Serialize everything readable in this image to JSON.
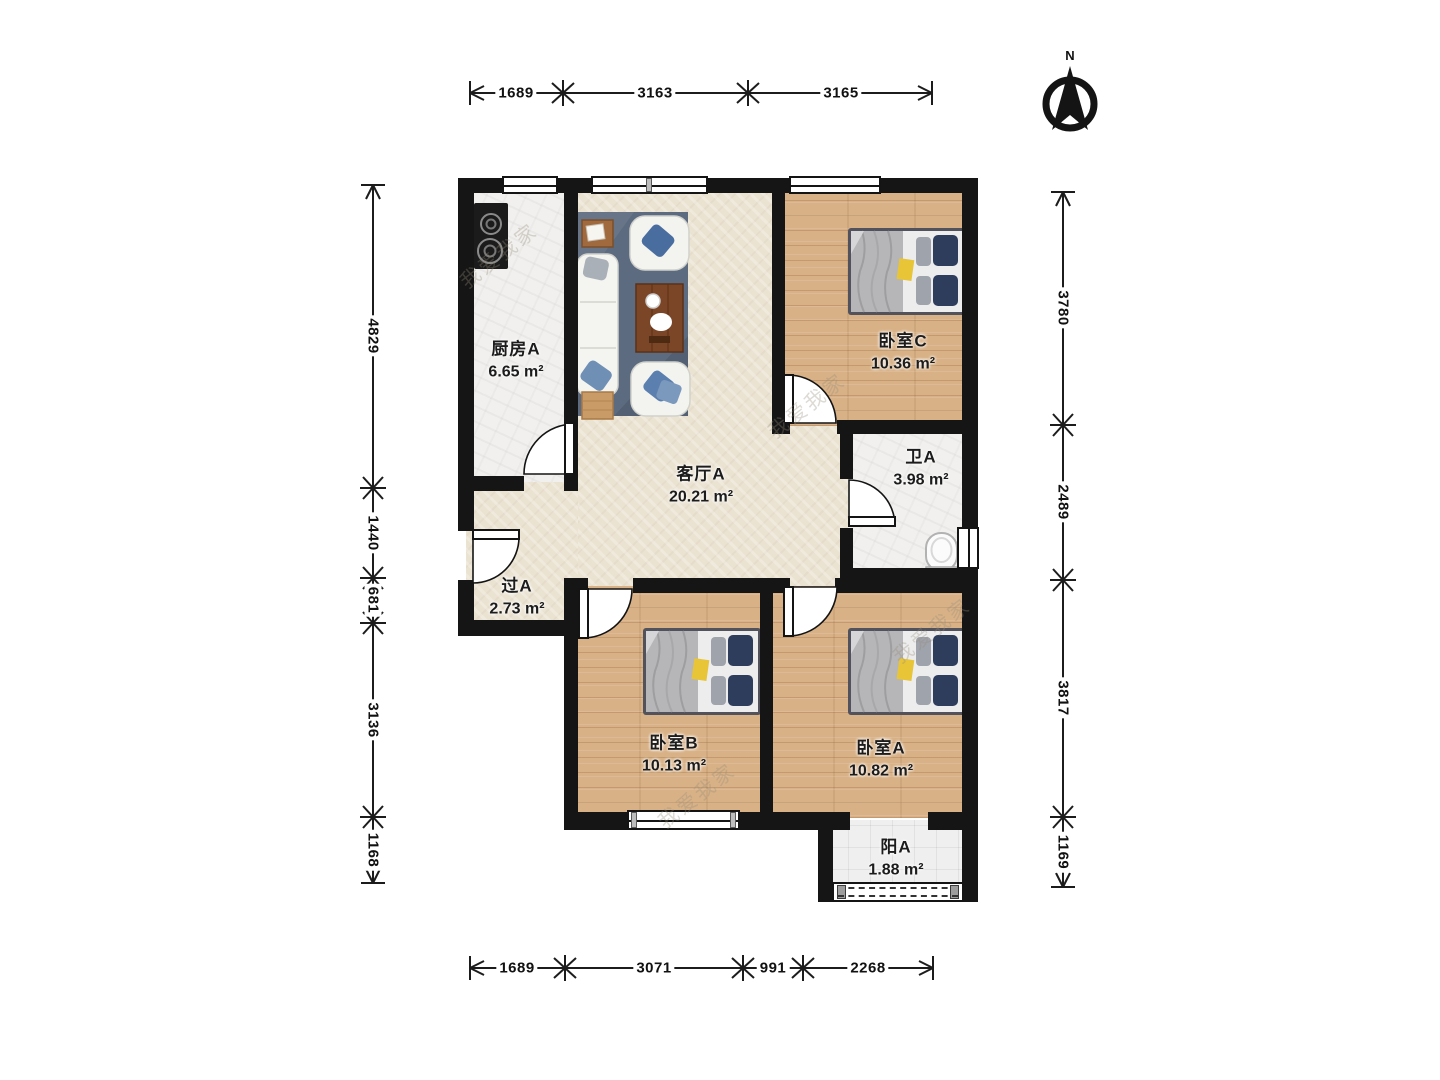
{
  "title": "三室一厅户型图",
  "compass": {
    "label": "N"
  },
  "watermark": {
    "text": "我爱我家"
  },
  "rooms": {
    "kitchen": {
      "name": "厨房A",
      "area": "6.65 m²"
    },
    "living": {
      "name": "客厅A",
      "area": "20.21 m²"
    },
    "bedroom_c": {
      "name": "卧室C",
      "area": "10.36 m²"
    },
    "bath": {
      "name": "卫A",
      "area": "3.98 m²"
    },
    "hall": {
      "name": "过A",
      "area": "2.73 m²"
    },
    "bedroom_b": {
      "name": "卧室B",
      "area": "10.13 m²"
    },
    "bedroom_a": {
      "name": "卧室A",
      "area": "10.82 m²"
    },
    "balcony": {
      "name": "阳A",
      "area": "1.88 m²"
    }
  },
  "dimensions": {
    "top": [
      "1689",
      "3163",
      "3165"
    ],
    "bottom": [
      "1689",
      "3071",
      "991",
      "2268"
    ],
    "left": [
      "4829",
      "1440",
      "681",
      "3136",
      "1168"
    ],
    "right": [
      "3780",
      "2489",
      "3817",
      "1169"
    ]
  },
  "colors": {
    "wall": "#151515",
    "wood_floor": "#d8b186",
    "tile_floor": "#f1f0ee",
    "living_floor": "#ebe3d2",
    "rug": "#5d6b80",
    "pillow_navy": "#2e3d5c",
    "table_wood": "#7b4627",
    "accent_yellow": "#e8c437"
  }
}
